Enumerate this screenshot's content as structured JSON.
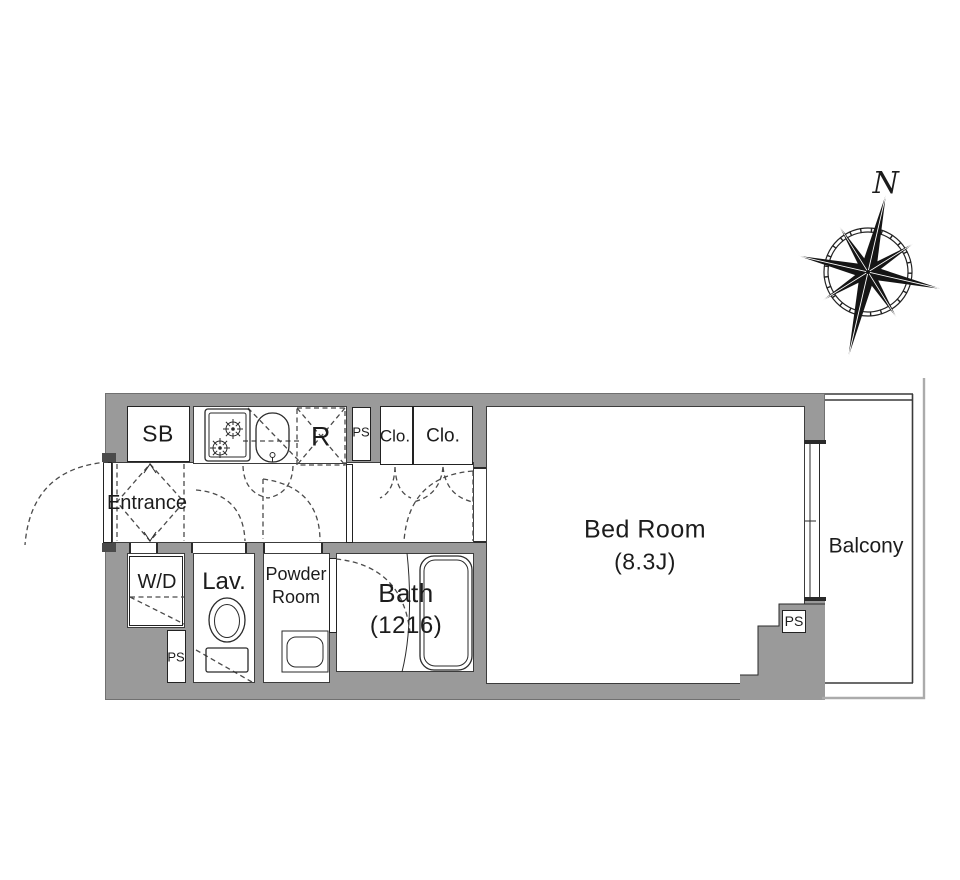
{
  "title": "apartment-floor-plan",
  "colors": {
    "wall": "#9a9a9a",
    "line": "#2a2a2a",
    "dashed_line": "#4a4a4a",
    "outer_balcony_line": "#ababab",
    "text": "#1c1c1c",
    "background": "#ffffff"
  },
  "rooms": {
    "sb": "SB",
    "entrance": "Entrance",
    "range": "R",
    "ps_kitchen": "PS",
    "closet1": "Clo.",
    "closet2": "Clo.",
    "bedroom": {
      "name": "Bed Room",
      "size": "(8.3J)"
    },
    "balcony": "Balcony",
    "washer_dryer": "W/D",
    "lavatory": "Lav.",
    "powder": {
      "line1": "Powder",
      "line2": "Room"
    },
    "bath": {
      "name": "Bath",
      "size": "(1216)"
    },
    "ps_washer": "PS",
    "ps_bedroom": "PS"
  },
  "compass": {
    "north": "N"
  },
  "icons": {
    "compass-rose-icon": "eight-point star with N needle",
    "stove-icon": "two-burner gas stove",
    "kitchen-sink-icon": "rounded sink basin",
    "toilet-icon": "toilet with tank",
    "bathtub-icon": "rounded bathtub",
    "washbasin-icon": "powder room basin",
    "door-swing-arc": "dashed quarter-circle",
    "sliding-window": "double-track window"
  }
}
